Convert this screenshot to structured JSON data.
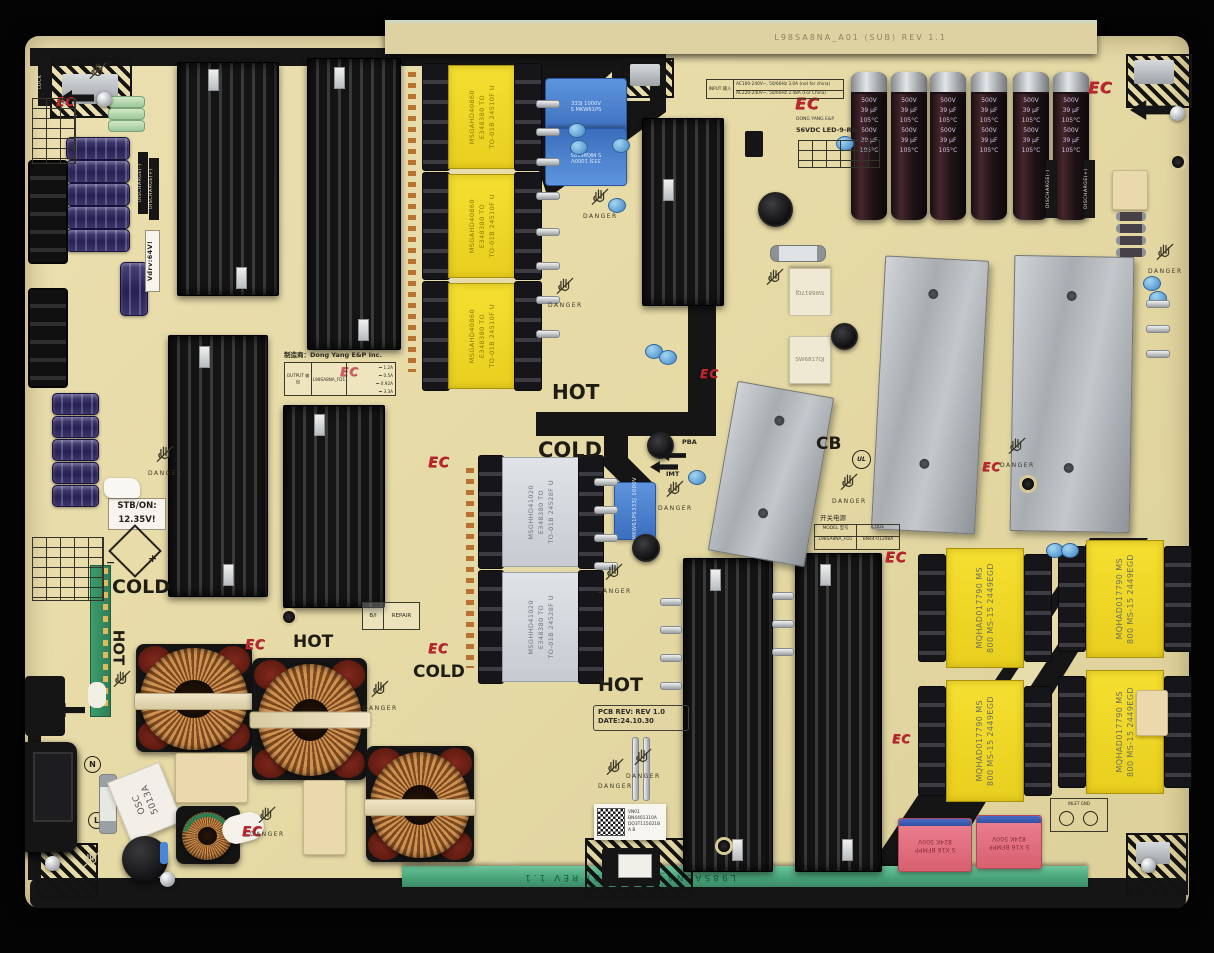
{
  "zone": {
    "hot": "HOT",
    "cold": "COLD"
  },
  "warn": {
    "danger": "DANGER",
    "discharge_pos": "DISCHARGE(+)",
    "discharge_neg": "DISCHARGE(-)"
  },
  "logos": {
    "ec": "EC",
    "cb": "CB",
    "ul": "UL",
    "brand": "DONG YANG E&P",
    "spec": "56VDC LED-9-RAA"
  },
  "header": {
    "sub_edge": "L98SA8NA_A01 (SUB) REV 1.1"
  },
  "input": {
    "title": "INPUT 输入",
    "line1": "AC100-240V~, 50/60Hz 3.0A (not for china)",
    "line2": "AC220-240V~, 50/60Hz 2.48A (For China)"
  },
  "output": {
    "title": "OUTPUT 输出",
    "model": "L98SA8NA_FD1",
    "lines": [
      "⎓ 1.2A",
      "⎓ 0.5A",
      "⎓ 0.92A",
      "⎓ 3.3A"
    ]
  },
  "maker": {
    "label": "制造商：Dong Yang E&P Inc."
  },
  "idplate": {
    "model_key": "MODEL 型号",
    "model_val": "L98SA8NA_FD1",
    "code_key": "CODE",
    "code_val": "BN44-01208A",
    "type_cn": "开关电源"
  },
  "rev": {
    "line1": "PCB REV: REV 1.0",
    "line2": "DATE:24.10.30"
  },
  "sticker": {
    "l1": "VN01",
    "l2": "BN4401310A",
    "l3": "DQ3T115021B",
    "l4": "A B"
  },
  "marks": {
    "lock": "LOCK",
    "stb1": "STB/ON:",
    "stb2": "12.35V!",
    "vdrv": "Vdrv:64V!",
    "pba": "PBA",
    "imt": "IMT",
    "repair_l": "B/I",
    "repair_r": "REPAIR",
    "inlet_n": "N",
    "inlet_l": "L",
    "minus": "−",
    "plus": "+",
    "gnd": "INLET GND"
  },
  "parts": {
    "cap500": {
      "v": "500V",
      "uf": "39 μF",
      "t": "105°C"
    },
    "film_blue": {
      "l1": "333J 1000V",
      "l2": "S MKW61PS"
    },
    "film_red": {
      "l1": "824K 500V",
      "l2": "S X16 BFMPP"
    },
    "tx_top": {
      "l1": "MSGAHD40860",
      "l2": "E348380 TO",
      "l3": "TO-01B 24510F U"
    },
    "tx_mid": {
      "l1": "MSGHHD41020",
      "l2": "E348380 TO",
      "l3": "TO-01B 24528F U"
    },
    "tx_corner": {
      "l1": "MQHAD017790  MS",
      "l2": "800 MS-15 2449EGD"
    },
    "sw": "SW6817QJ",
    "ceramic": {
      "l1": "OSC",
      "l2": "5013A"
    }
  }
}
